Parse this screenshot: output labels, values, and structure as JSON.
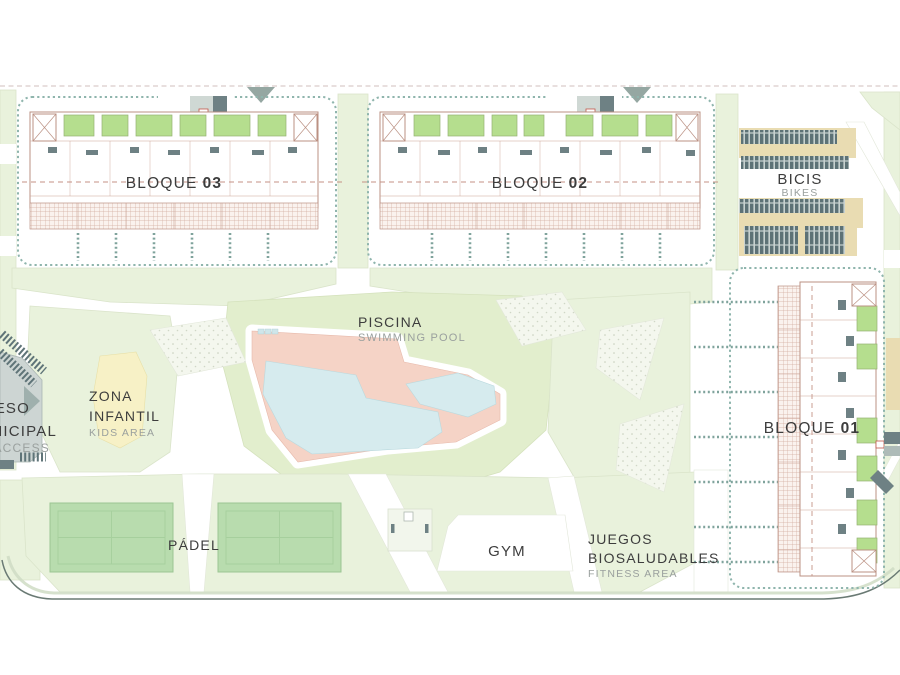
{
  "site": {
    "blocks": {
      "b03": {
        "word": "BLOQUE",
        "num": "03"
      },
      "b02": {
        "word": "BLOQUE",
        "num": "02"
      },
      "b01": {
        "word": "BLOQUE",
        "num": "01"
      }
    },
    "bikes": {
      "title": "BICIS",
      "sub": "BIKES"
    },
    "pool": {
      "title": "PISCINA",
      "sub": "SWIMMING POOL"
    },
    "kids": {
      "l1": "ZONA",
      "l2": "INFANTIL",
      "sub": "KIDS AREA"
    },
    "padel": {
      "title": "PÁDEL"
    },
    "gym": {
      "title": "GYM"
    },
    "fitness": {
      "l1": "JUEGOS",
      "l2": "BIOSALUDABLES",
      "sub": "FITNESS AREA"
    },
    "access": {
      "l1": "ACCESO",
      "l2": "MUNICIPAL",
      "sub": "ACCESS"
    },
    "colors": {
      "lawn": "#e9f2dc",
      "lawn_deep": "#e2eecd",
      "pool_deck": "#f5d3c6",
      "pool_water": "#d6ebee",
      "padel_court": "#b8dcae",
      "kids_yellow": "#f7f1c6",
      "bike_rack_tan": "#e9dcb2",
      "slate": "#5d7276",
      "building_line": "#bb9183",
      "hedge_green": "#8fb5ad",
      "text_dark": "#3d3d3d",
      "text_light": "#9aa09e"
    }
  }
}
